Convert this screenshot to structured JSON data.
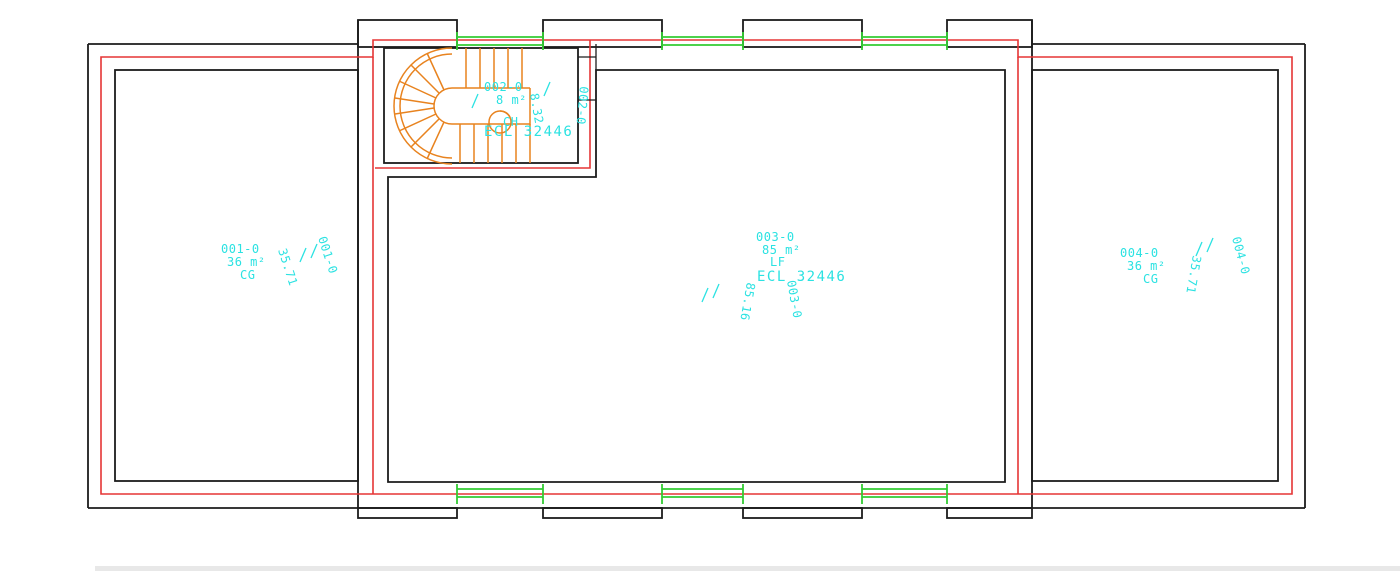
{
  "colors": {
    "wall": "#1c1c1c",
    "insulation": "#e53535",
    "window": "#33cc33",
    "stair": "#e8831f",
    "label": "#2be2e2",
    "footer_bar": "#e8e8e8"
  },
  "rooms": [
    {
      "id": "001-0",
      "area": "36 m²",
      "type": "CG",
      "area_exact": "35.71",
      "id_rotated": "001-0"
    },
    {
      "id": "002-0",
      "area": "8 m²",
      "type": "CH",
      "ref": "ECL 32446",
      "area_exact": "8.32",
      "id_rotated": "002-0"
    },
    {
      "id": "003-0",
      "area": "85 m²",
      "type": "LF",
      "ref": "ECL 32446",
      "area_exact": "85.16",
      "id_rotated": "003-0"
    },
    {
      "id": "004-0",
      "area": "36 m²",
      "type": "CG",
      "area_exact": "35.71",
      "id_rotated": "004-0"
    }
  ]
}
